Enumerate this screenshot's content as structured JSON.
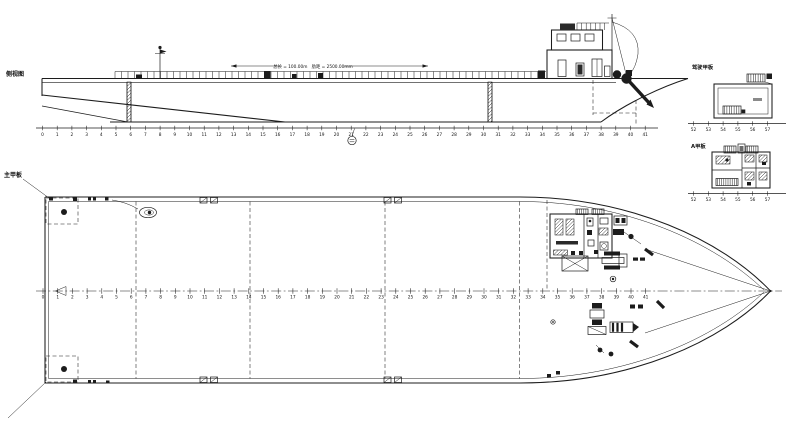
{
  "drawing": {
    "background": "#ffffff",
    "line_color": "#1c1c1c",
    "views": {
      "profile": {
        "title": "侧视图",
        "dimension_note": "总长 = 100.00m　肋距 = 2500.00mm"
      },
      "plan": {
        "title": "主甲板"
      },
      "bridge_deck": {
        "title": "驾驶甲板"
      },
      "a_deck": {
        "title": "A甲板"
      }
    },
    "frame_numbers_main": [
      0,
      1,
      2,
      3,
      4,
      5,
      6,
      7,
      8,
      9,
      10,
      11,
      12,
      13,
      14,
      15,
      16,
      17,
      18,
      19,
      20,
      21,
      22,
      23,
      24,
      25,
      26,
      27,
      28,
      29,
      30,
      31,
      32,
      33,
      34,
      35,
      36,
      37,
      38,
      39,
      40,
      41
    ],
    "frame_numbers_detail": [
      52,
      53,
      54,
      55,
      56,
      57
    ]
  }
}
